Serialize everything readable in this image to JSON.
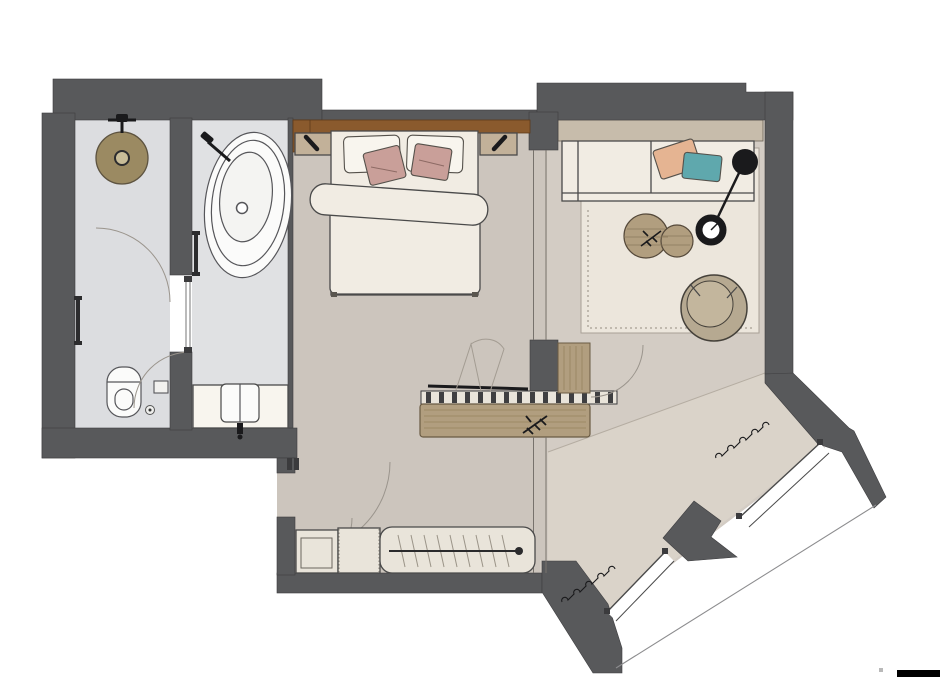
{
  "meta": {
    "kind": "architectural floor plan",
    "view": "top-down rendered interior plan of a hotel room / suite",
    "visible_text": []
  },
  "palette": {
    "wall": "#58595b",
    "floor_main": "#ccc5bd",
    "floor_hall": "#d3ccc4",
    "floor_window": "#dad3c9",
    "floor_bath": "#dcdde0",
    "floor_bath2": "#e0e1e3",
    "rug": "#ece6dc",
    "cream": "#f1ece3",
    "cream_light": "#f8f5ee",
    "white_fixture": "#fbfbfa",
    "wardrobe": "#e9e4da",
    "wood_dark": "#8a5a2d",
    "wood_mid": "#b19e7f",
    "wood_light": "#c7bcab",
    "nightstand": "#c2b199",
    "armchair": "#b6a991",
    "armchair_inner": "#c3b69d",
    "pink": "#c99f99",
    "peach": "#e5b492",
    "teal": "#5fa8ad",
    "shower": "#9b8a62",
    "black": "#1a1a1c",
    "window_white": "#ffffff"
  },
  "rooms": [
    {
      "name": "shower-wc-room",
      "fixtures": [
        "rain-shower-head",
        "shower-valve",
        "towel-rail",
        "wall-hung-toilet",
        "toilet-paper-holder",
        "floor-drain",
        "door-swing-arcs"
      ]
    },
    {
      "name": "bathtub-room",
      "fixtures": [
        "freestanding-bathtub",
        "wall-faucet",
        "towel-rail",
        "vanity-counter",
        "sink",
        "glass-sliding-door"
      ]
    },
    {
      "name": "bedroom",
      "furniture": [
        "double-bed",
        "two-white-pillows",
        "two-pink-accent-pillows",
        "duvet-with-fold",
        "wood-headboard-panel",
        "nightstand-left",
        "nightstand-right",
        "wall-lamp-left",
        "wall-lamp-right",
        "desk-with-sketched-chair",
        "slatted-bench-radiator",
        "wood-sideboard",
        "plant-sprig"
      ]
    },
    {
      "name": "living-area",
      "furniture": [
        "sofa",
        "peach-pillow",
        "teal-pillow",
        "wood-shelf-band",
        "area-rug",
        "coffee-table-large",
        "coffee-table-small",
        "plant-sprig",
        "black-floor-lamp",
        "tub-armchair",
        "glass-partition"
      ]
    },
    {
      "name": "entry-hall",
      "furniture": [
        "entry-door-swing-arcs",
        "shelf-unit",
        "open-cabinet",
        "wardrobe-with-hanging-rail",
        "curtains",
        "diagonal-window-upper",
        "diagonal-window-lower",
        "window-pier"
      ]
    }
  ],
  "annotations": {
    "scale_bar_bottom_right": true
  }
}
